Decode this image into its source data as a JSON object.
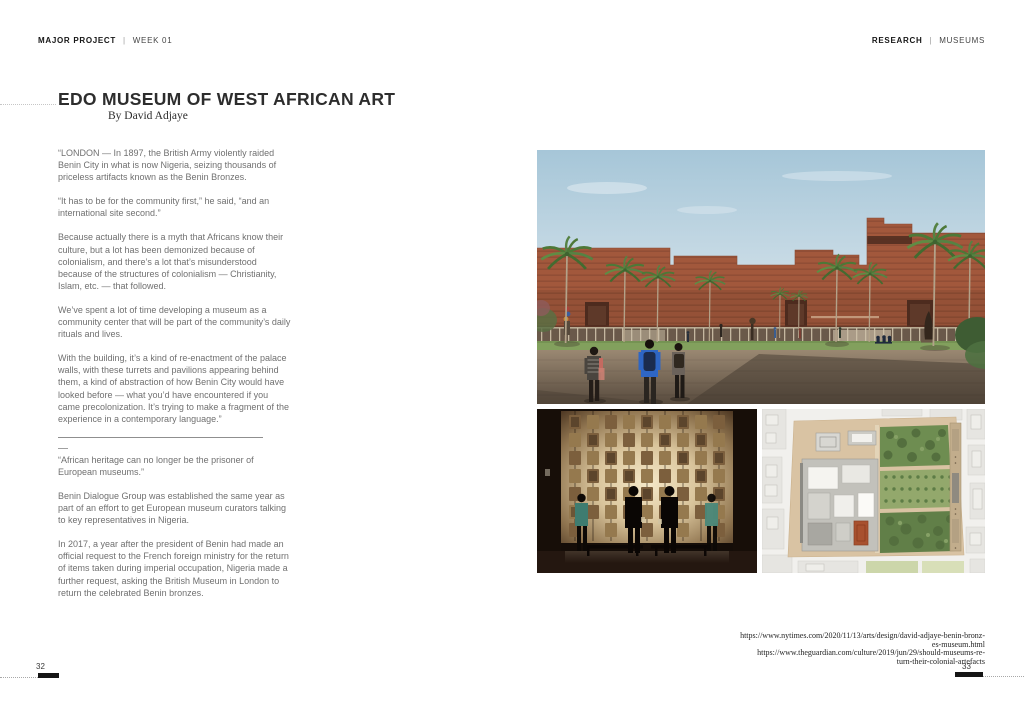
{
  "header": {
    "left": {
      "primary": "MAJOR PROJECT",
      "divider": "|",
      "secondary": "WEEK 01"
    },
    "right": {
      "primary": "RESEARCH",
      "divider": "|",
      "secondary": "MUSEUMS"
    }
  },
  "title": "EDO MUSEUM OF WEST AFRICAN ART",
  "byline": "By David Adjaye",
  "article": {
    "paragraphs": [
      "“LONDON — In 1897, the British Army violently raided Benin City in what is now Nigeria, seizing thousands of priceless artifacts known as the Benin Bronzes.",
      "“It has to be for the community first,” he said, “and an international site second.”",
      "Because actually there is a myth that Africans know their culture, but a lot has been demonized because of colonialism, and there’s a lot that’s misunderstood because of the structures of colonialism — Christianity, Islam, etc. — that followed.",
      "We’ve spent a lot of time developing a museum as a community center that will be part of the community’s daily rituals and lives.",
      "With the building, it’s a kind of re-enactment of the palace walls, with these turrets and pavilions appearing behind them, a kind of abstraction of how Benin City would have looked before — what you’d have encountered if you came precolonization. It’s trying to make a fragment of the experience in a contemporary language.”",
      "“African heritage can no longer be the prisoner of European museums.”",
      "Benin Dialogue Group was established the same year as part of an effort to get European museum curators talking to key representatives in Nigeria.",
      "In 2017, a year after the president of Benin had made an official request to the French foreign ministry for the return of items taken during imperial occupation, Nigeria made a further request, asking the British Museum in London to return the celebrated Benin bronzes."
    ]
  },
  "citations": {
    "lines": [
      "https://www.nytimes.com/2020/11/13/arts/design/david-adjaye-benin-bronz-",
      "es-museum.html",
      "https://www.theguardian.com/culture/2019/jun/29/should-museums-re-",
      "turn-their-colonial-artefacts"
    ]
  },
  "footer": {
    "left_page": "32",
    "right_page": "33"
  },
  "images": {
    "exterior": {
      "label": "Exterior rendering of the Edo Museum of West African Art"
    },
    "interior": {
      "label": "Benin bronzes gallery interior with visitors"
    },
    "site_plan": {
      "label": "Museum site plan with gardens"
    }
  },
  "colors": {
    "page_bg": "#ffffff",
    "heading_text": "#2d2d2d",
    "body_text": "#707070",
    "footer_bar": "#151515",
    "sky_blue": "#aac9da",
    "building_terracotta": "#a2583c",
    "lawn_green": "#82a05d",
    "plaza_brown": "#8d7a66",
    "interior_glow": "#f5e8c8",
    "bronze_plaque": "#8a6b45",
    "teal_shirt": "#3e7c70",
    "blue_shirt": "#2e66c4",
    "plan_parcel_tan": "#d9c3a3",
    "plan_garden_green": "#6e8d51",
    "plan_courtyard_red": "#a8512f"
  }
}
